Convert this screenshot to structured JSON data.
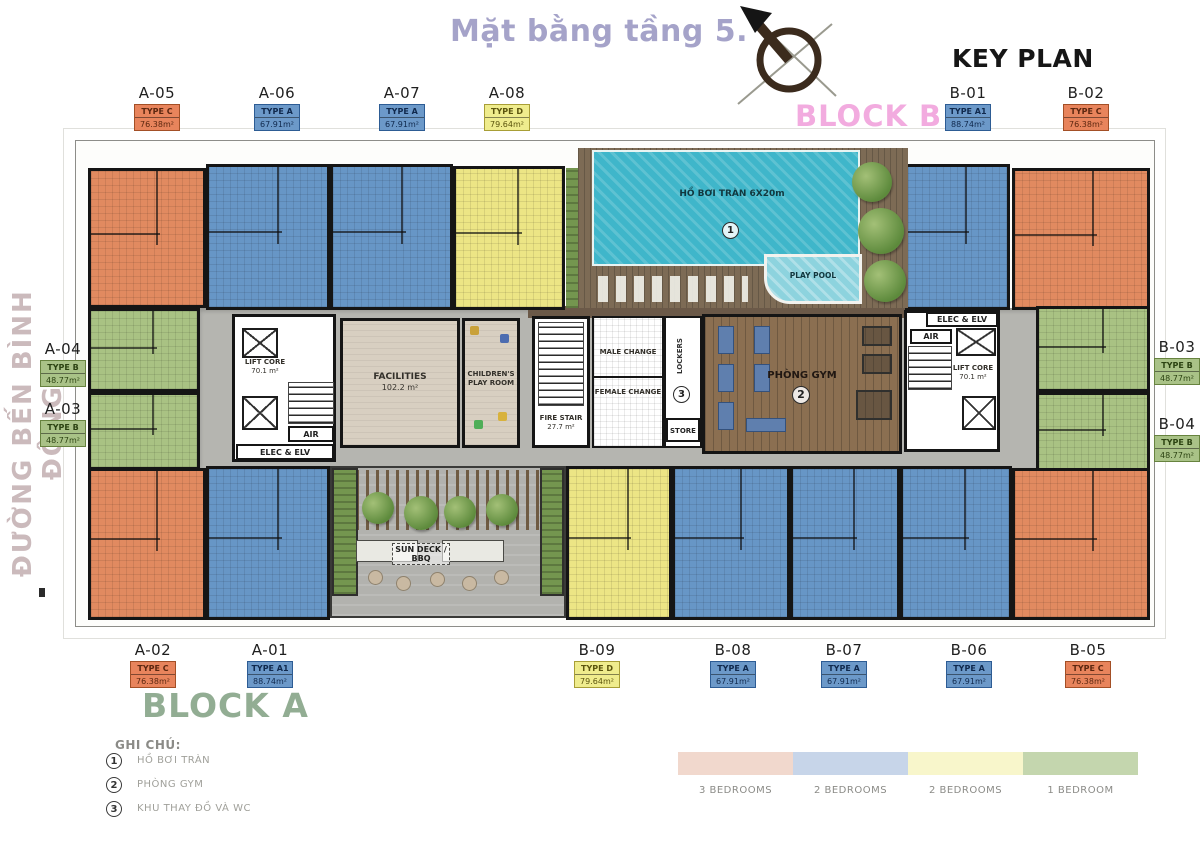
{
  "header": {
    "title": "Mặt bằng tầng 5.",
    "key_plan": "KEY PLAN",
    "block_b": "BLOCK B",
    "block_a": "BLOCK A",
    "street": "ĐƯỜNG BẾN BÌNH ĐÔNG"
  },
  "units": [
    {
      "id": "A-05",
      "type": "TYPE C",
      "area": "76.38m²",
      "category": "3br"
    },
    {
      "id": "A-06",
      "type": "TYPE A",
      "area": "67.91m²",
      "category": "2br_blue"
    },
    {
      "id": "A-07",
      "type": "TYPE A",
      "area": "67.91m²",
      "category": "2br_blue"
    },
    {
      "id": "A-08",
      "type": "TYPE D",
      "area": "79.64m²",
      "category": "2br_yellow"
    },
    {
      "id": "B-01",
      "type": "TYPE A1",
      "area": "88.74m²",
      "category": "2br_blue"
    },
    {
      "id": "B-02",
      "type": "TYPE C",
      "area": "76.38m²",
      "category": "3br"
    },
    {
      "id": "A-04",
      "type": "TYPE B",
      "area": "48.77m²",
      "category": "1br"
    },
    {
      "id": "A-03",
      "type": "TYPE B",
      "area": "48.77m²",
      "category": "1br"
    },
    {
      "id": "B-03",
      "type": "TYPE B",
      "area": "48.77m²",
      "category": "1br"
    },
    {
      "id": "B-04",
      "type": "TYPE B",
      "area": "48.77m²",
      "category": "1br"
    },
    {
      "id": "A-02",
      "type": "TYPE C",
      "area": "76.38m²",
      "category": "3br"
    },
    {
      "id": "A-01",
      "type": "TYPE A1",
      "area": "88.74m²",
      "category": "2br_blue"
    },
    {
      "id": "B-09",
      "type": "TYPE D",
      "area": "79.64m²",
      "category": "2br_yellow"
    },
    {
      "id": "B-08",
      "type": "TYPE A",
      "area": "67.91m²",
      "category": "2br_blue"
    },
    {
      "id": "B-07",
      "type": "TYPE A",
      "area": "67.91m²",
      "category": "2br_blue"
    },
    {
      "id": "B-06",
      "type": "TYPE A",
      "area": "67.91m²",
      "category": "2br_blue"
    },
    {
      "id": "B-05",
      "type": "TYPE C",
      "area": "76.38m²",
      "category": "3br"
    }
  ],
  "plan": {
    "pool": {
      "label": "HỒ BƠI TRÀN 6X20m",
      "marker": "1"
    },
    "play_pool": "PLAY POOL",
    "lift_core_left": {
      "name": "LIFT CORE",
      "area": "70.1 m²"
    },
    "air_left": "AIR",
    "elec_left": "ELEC & ELV",
    "facilities": {
      "name": "FACILITIES",
      "area": "102.2 m²"
    },
    "children_room": "CHILDREN'S PLAY ROOM",
    "fire_stair": {
      "name": "FIRE STAIR",
      "area": "27.7 m²"
    },
    "male_change": "MALE CHANGE",
    "female_change": "FEMALE CHANGE",
    "lockers": "LOCKERS",
    "store": "STORE",
    "change_marker": "3",
    "gym": {
      "name": "PHÒNG GYM",
      "marker": "2"
    },
    "elec_right": "ELEC & ELV",
    "air_right": "AIR",
    "lift_core_right": {
      "name": "LIFT CORE",
      "area": "70.1 m²"
    },
    "sun_deck": "SUN DECK / BBQ"
  },
  "notes": {
    "title": "GHI CHÚ:",
    "items": [
      {
        "num": "1",
        "label": "HỒ BƠI TRÀN"
      },
      {
        "num": "2",
        "label": "PHÒNG GYM"
      },
      {
        "num": "3",
        "label": "KHU THAY ĐỒ VÀ WC"
      }
    ]
  },
  "bedroom_legend": [
    {
      "label": "3 BEDROOMS",
      "color": "#f1d8cd"
    },
    {
      "label": "2 BEDROOMS",
      "color": "#c7d5e9"
    },
    {
      "label": "2 BEDROOMS",
      "color": "#f8f6cb"
    },
    {
      "label": "1 BEDROOM",
      "color": "#c4d6ae"
    }
  ],
  "colors": {
    "orange": "#e18a60",
    "blue": "#6796c6",
    "yellow": "#ece585",
    "green": "#a9c283",
    "pool": "#3fb6ca",
    "deck": "#7d6b55",
    "corridor": "#b5b5b0",
    "gym": "#8b6f51",
    "accent_title": "#a5a3c9",
    "accent_block_b": "#f2abdf",
    "accent_block_a": "#92ad93",
    "street": "#cbbabc"
  }
}
